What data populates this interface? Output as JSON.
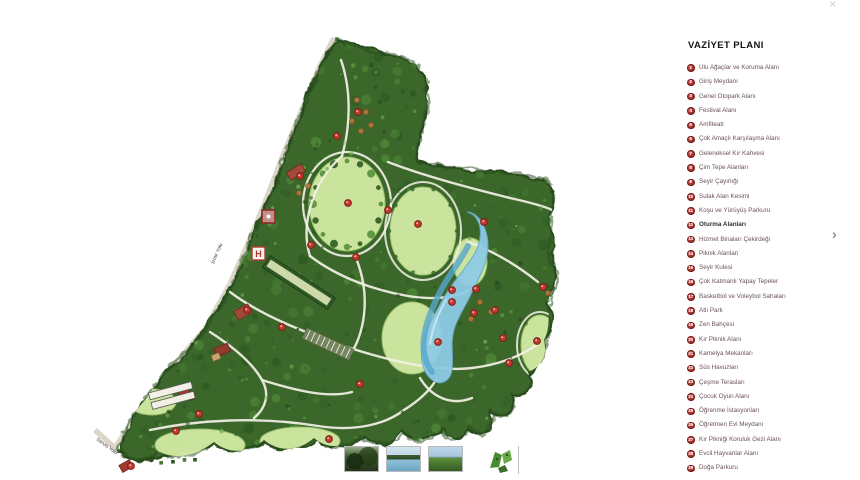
{
  "window": {
    "close_icon": "✕"
  },
  "legend": {
    "title": "VAZİYET PLANI",
    "items": [
      {
        "num": 1,
        "label": "Ulu Ağaçlar ve Koruma Alanı",
        "bold": false
      },
      {
        "num": 2,
        "label": "Giriş Meydanı",
        "bold": false
      },
      {
        "num": 3,
        "label": "Genel Otopark Alanı",
        "bold": false
      },
      {
        "num": 4,
        "label": "Festival Alanı",
        "bold": false
      },
      {
        "num": 5,
        "label": "Amfiteatr",
        "bold": false
      },
      {
        "num": 6,
        "label": "Çok Amaçlı Karşılaşma Alanı",
        "bold": false
      },
      {
        "num": 7,
        "label": "Geleneksel Kır Kahvesi",
        "bold": false
      },
      {
        "num": 8,
        "label": "Çim Tepe Alanları",
        "bold": false
      },
      {
        "num": 9,
        "label": "Seyir Çayırlığı",
        "bold": false
      },
      {
        "num": 10,
        "label": "Sulak Alan Kesimi",
        "bold": false
      },
      {
        "num": 11,
        "label": "Koşu ve Yürüyüş Parkuru",
        "bold": false
      },
      {
        "num": 12,
        "label": "Oturma Alanları",
        "bold": true
      },
      {
        "num": 13,
        "label": "Hizmet Binaları Çekirdeği",
        "bold": false
      },
      {
        "num": 14,
        "label": "Piknik Alanları",
        "bold": false
      },
      {
        "num": 15,
        "label": "Seyir Kulesi",
        "bold": false
      },
      {
        "num": 16,
        "label": "Çok Katmanlı Yapay Tepeler",
        "bold": false
      },
      {
        "num": 17,
        "label": "Basketbol ve Voleybol Sahaları",
        "bold": false
      },
      {
        "num": 18,
        "label": "Atlı Park",
        "bold": false
      },
      {
        "num": 19,
        "label": "Zen Bahçesi",
        "bold": false
      },
      {
        "num": 20,
        "label": "Kır Piknik Alanı",
        "bold": false
      },
      {
        "num": 21,
        "label": "Kamelya Mekanları",
        "bold": false
      },
      {
        "num": 22,
        "label": "Süs Havuzları",
        "bold": false
      },
      {
        "num": 23,
        "label": "Çeşme Terasları",
        "bold": false
      },
      {
        "num": 24,
        "label": "Çocuk Oyun Alanı",
        "bold": false
      },
      {
        "num": 25,
        "label": "Öğrenme İstasyonları",
        "bold": false
      },
      {
        "num": 26,
        "label": "Öğretmen Evi Meydanı",
        "bold": false
      },
      {
        "num": 27,
        "label": "Kır Pikniği Koruluk Gezi Alanı",
        "bold": false
      },
      {
        "num": 28,
        "label": "Evcil Hayvanlar Alanı",
        "bold": false
      },
      {
        "num": 29,
        "label": "Doğa Parkuru",
        "bold": false
      }
    ]
  },
  "carousel": {
    "next_icon": "›"
  },
  "map": {
    "colors": {
      "forest_base": "#3b672b",
      "forest_dark": "#2a4f1f",
      "lawn": "#cfe8a2",
      "water": "#8ecbe4",
      "water_deep": "#57a5cd",
      "path": "#f4f1e6",
      "marker_red": "#c13b2e",
      "building_red": "#9c4a3a",
      "road": "#dbd6c9"
    },
    "road_labels": [
      {
        "text": "İzmir Yolu",
        "x": 214,
        "y": 264,
        "angle": -67
      },
      {
        "text": "Servis Yolu",
        "x": 96,
        "y": 440,
        "angle": 36
      }
    ],
    "markers": [
      [
        358,
        112
      ],
      [
        337,
        136
      ],
      [
        300,
        176
      ],
      [
        348,
        203
      ],
      [
        388,
        210
      ],
      [
        418,
        224
      ],
      [
        484,
        222
      ],
      [
        311,
        245
      ],
      [
        356,
        257
      ],
      [
        452,
        290
      ],
      [
        476,
        289
      ],
      [
        474,
        313
      ],
      [
        495,
        310
      ],
      [
        543,
        287
      ],
      [
        503,
        338
      ],
      [
        438,
        342
      ],
      [
        537,
        341
      ],
      [
        509,
        363
      ],
      [
        247,
        310
      ],
      [
        282,
        327
      ],
      [
        360,
        384
      ],
      [
        199,
        414
      ],
      [
        176,
        431
      ],
      [
        329,
        439
      ],
      [
        131,
        466
      ],
      [
        452,
        302
      ]
    ]
  },
  "thumbnails": [
    {
      "name": "photo-forest"
    },
    {
      "name": "photo-lake"
    },
    {
      "name": "photo-meadow"
    },
    {
      "name": "plan-icon"
    }
  ]
}
